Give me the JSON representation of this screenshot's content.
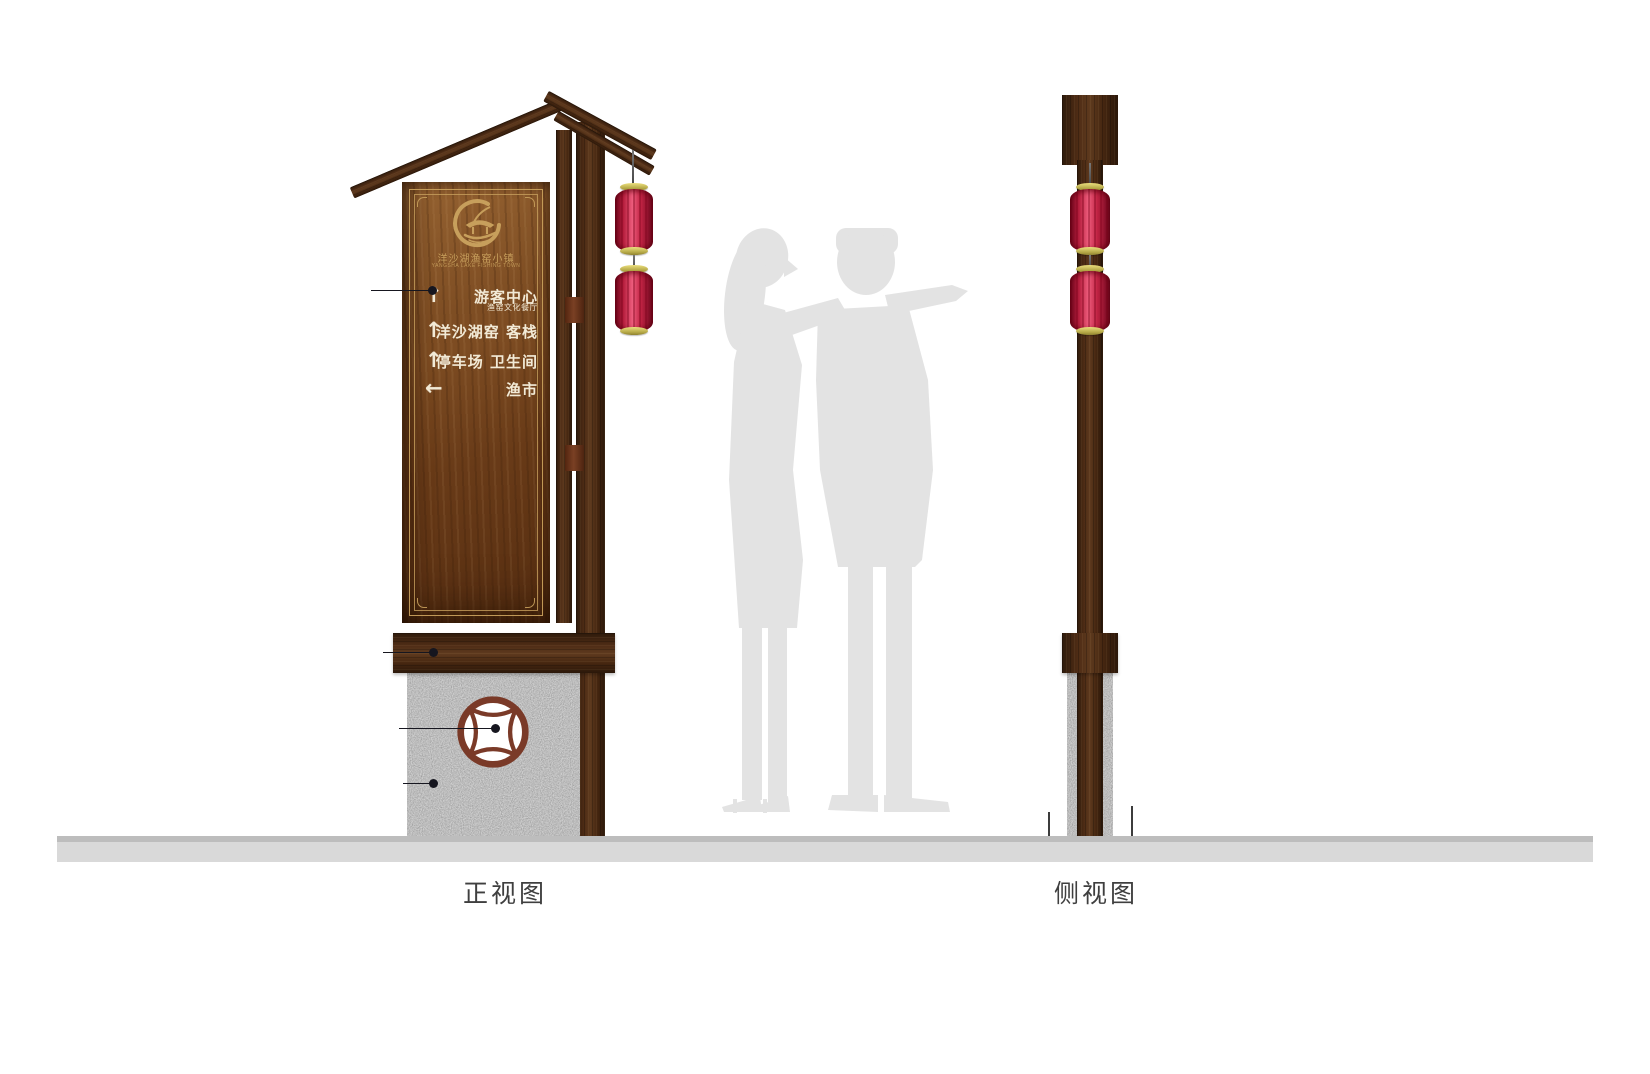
{
  "views": {
    "front": {
      "label": "正视图"
    },
    "side": {
      "label": "侧视图"
    }
  },
  "signboard": {
    "logo": {
      "name_cn": "洋沙湖渔窑小镇",
      "name_en": "YANGSHA LAKE FISHING TOWN"
    },
    "rows": [
      {
        "arrow": "↑",
        "text": "游客中心",
        "subtext": "渔窑文化餐厅"
      },
      {
        "arrow": "↑",
        "text": "洋沙湖窑 客栈"
      },
      {
        "arrow": "↑",
        "text": "停车场 卫生间"
      },
      {
        "arrow": "←",
        "text": "渔市"
      }
    ]
  },
  "colors": {
    "wood_dark": "#4a2a14",
    "wood_board": "#7d4c22",
    "frame_gold": "#c79f5c",
    "lantern_red": "#c4203f",
    "lantern_cap_gold": "#cfc46a",
    "stone_gray": "#a0a0a0",
    "ground_gray": "#d9d9d9",
    "silhouette_gray": "#e3e3e3",
    "text_cream": "#f2ead6",
    "label_gray": "#3f3f3f",
    "coin_brown": "#7a3a28",
    "annotation_dark": "#16161f"
  }
}
